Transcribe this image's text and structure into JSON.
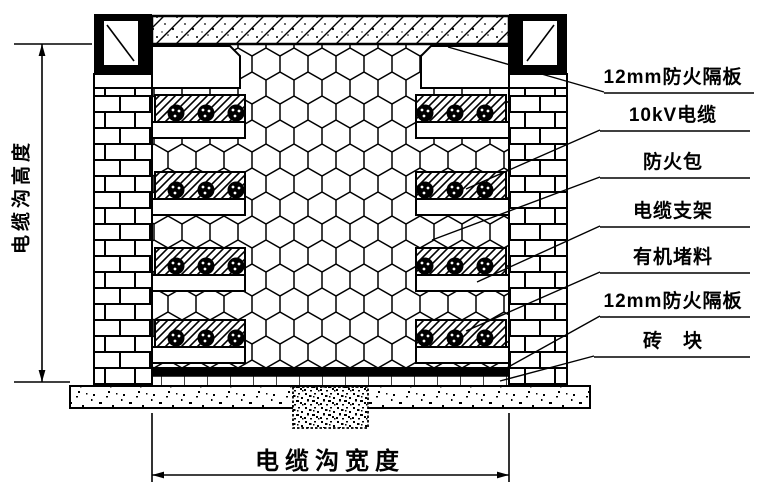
{
  "diagram": {
    "background": "#ffffff",
    "line_color": "#000000",
    "height_dimension_label": "电缆沟高度",
    "width_dimension_label": "电缆沟宽度",
    "callouts": [
      {
        "name": "fire-barrier-board-top",
        "label": "12mm防火隔板"
      },
      {
        "name": "cable-10kv",
        "label": "10kV电缆"
      },
      {
        "name": "fireproof-bag",
        "label": "防火包"
      },
      {
        "name": "cable-bracket",
        "label": "电缆支架"
      },
      {
        "name": "organic-sealant",
        "label": "有机堵料"
      },
      {
        "name": "fire-barrier-board-bottom",
        "label": "12mm防火隔板"
      },
      {
        "name": "brick-block",
        "label": "砖　块"
      }
    ]
  }
}
